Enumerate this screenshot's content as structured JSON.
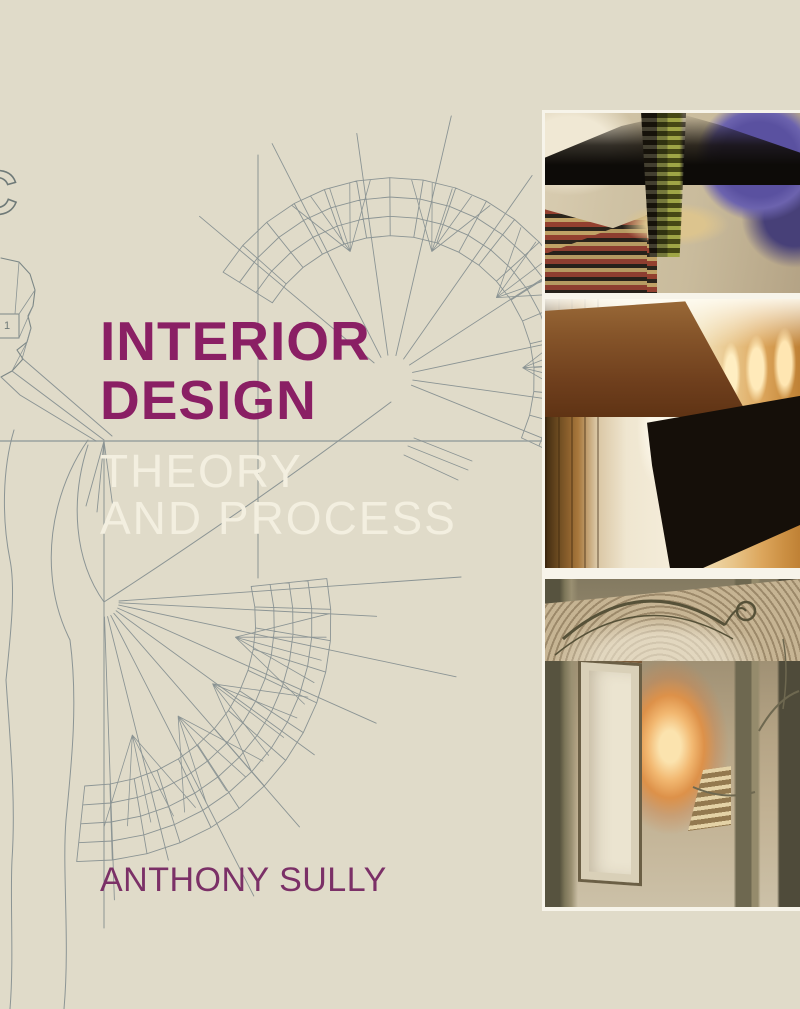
{
  "cover": {
    "background_color": "#e0dbc9",
    "title_line1": "INTERIOR",
    "title_line2": "DESIGN",
    "title_color": "#8a1f64",
    "subtitle_line1": "THEORY",
    "subtitle_line2": "AND PROCESS",
    "subtitle_color": "#f3efe0",
    "author": "ANTHONY SULLY",
    "author_color": "#7b3067",
    "line_art_color": "#8b9494",
    "edge_letter": "C",
    "figure_label": "1",
    "photos": [
      {
        "name": "theatre-interior-photo",
        "description": "colorful collaged theatre interior"
      },
      {
        "name": "corridor-interior-photo",
        "description": "warm minimalist corridor with lit wall and dark counter"
      },
      {
        "name": "staircase-interior-photo",
        "description": "art nouveau staircase hall with mosaic floor"
      }
    ]
  }
}
